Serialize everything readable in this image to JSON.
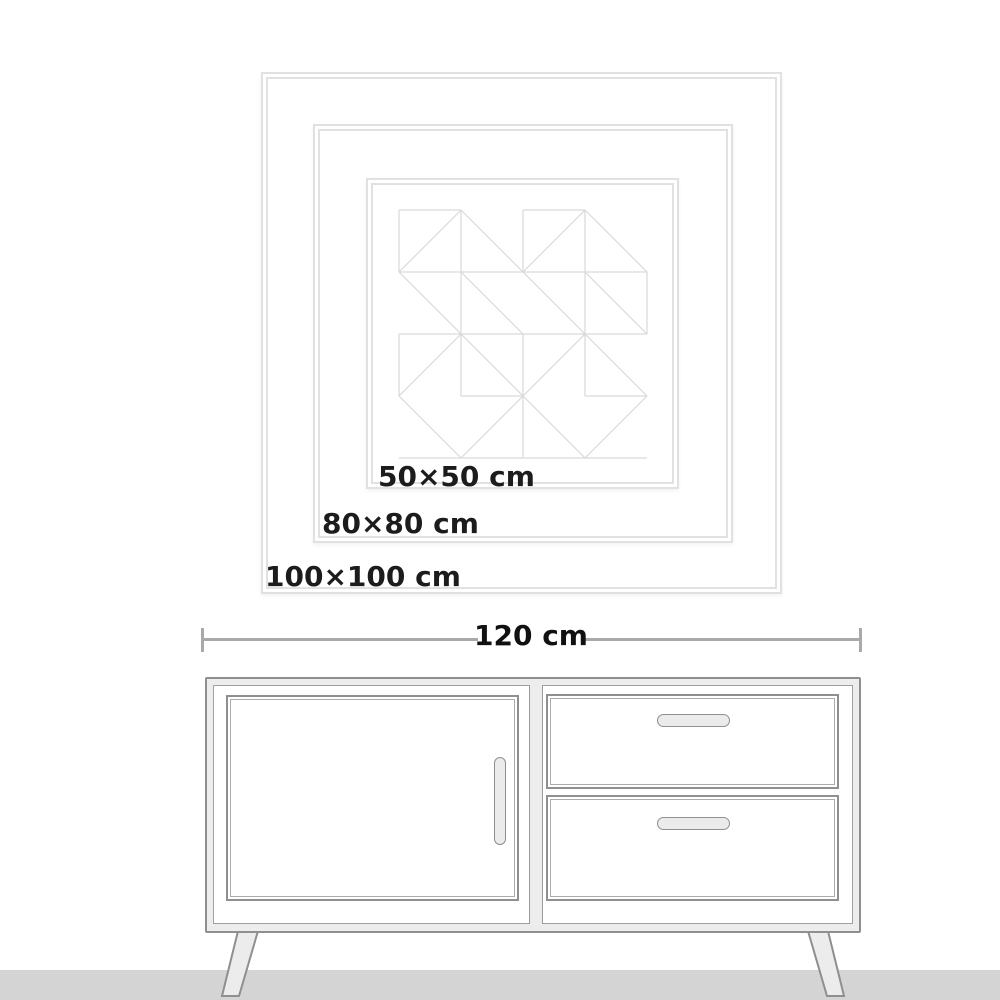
{
  "size_guide": {
    "sizes": [
      {
        "label": "50×50 cm",
        "width_cm": 50,
        "height_cm": 50
      },
      {
        "label": "80×80 cm",
        "width_cm": 80,
        "height_cm": 80
      },
      {
        "label": "100×100 cm",
        "width_cm": 100,
        "height_cm": 100
      }
    ]
  },
  "furniture": {
    "type": "sideboard",
    "width_label": "120 cm",
    "width_cm": 120
  },
  "colors": {
    "label_text": "#1c1c1c",
    "frame_line": "#e1e1e1",
    "pattern_line": "#d9d9d9",
    "dimension_line": "#a9a9a9",
    "cabinet_outline": "#8f8f8f",
    "cabinet_fill": "#ededed",
    "floor": "#d4d4d4"
  }
}
